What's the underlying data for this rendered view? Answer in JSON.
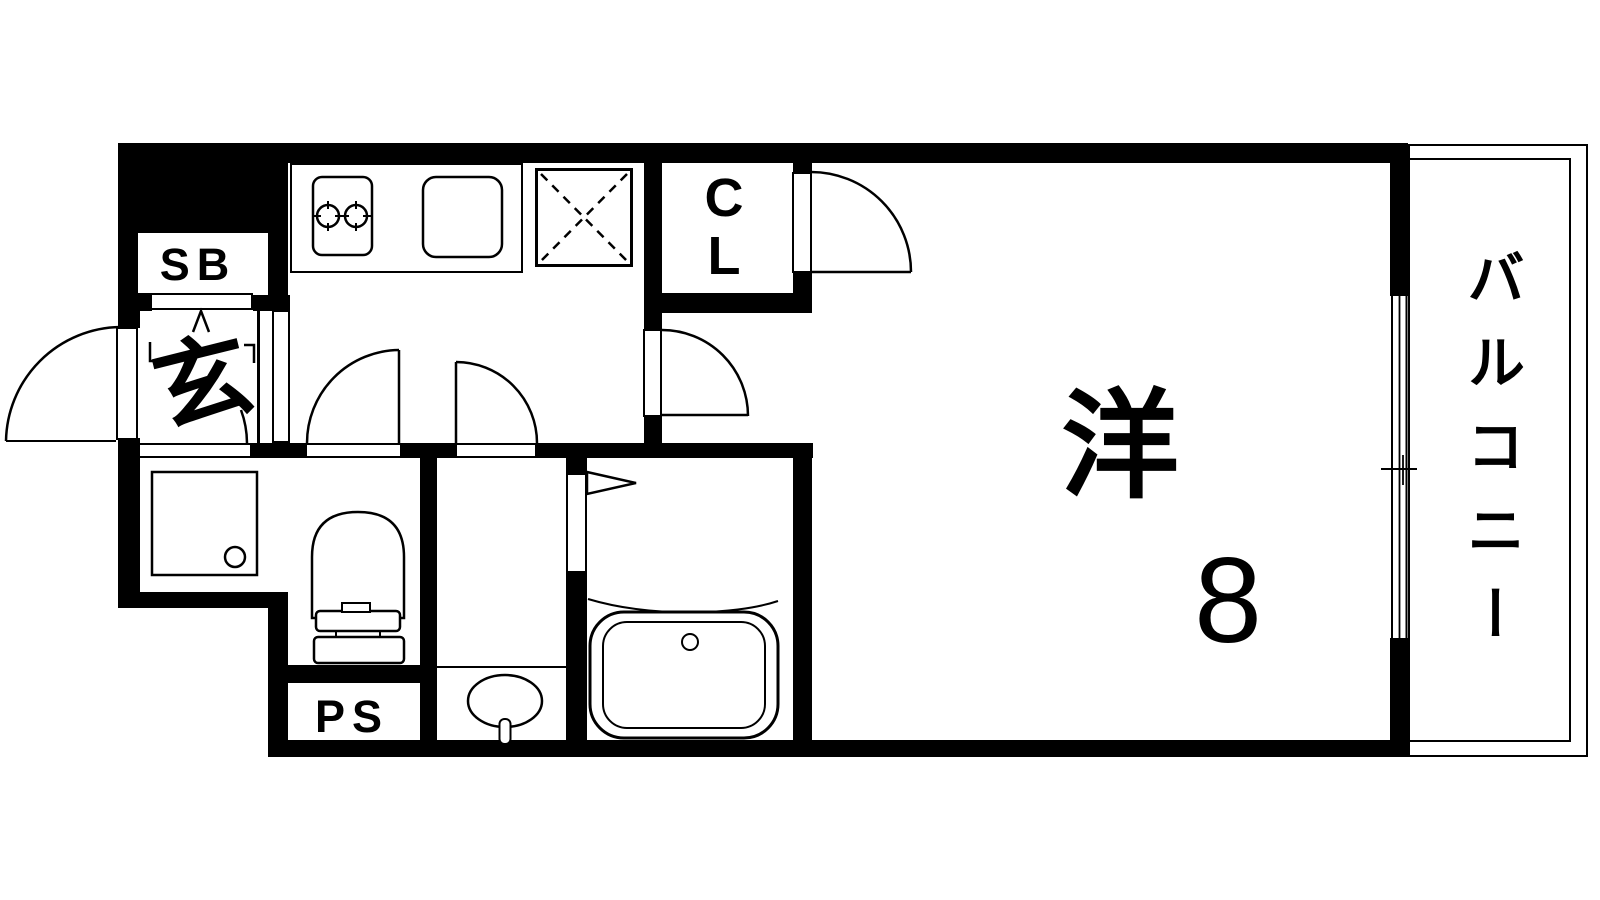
{
  "plan": {
    "type": "floor-plan",
    "colors": {
      "line": "#000000",
      "background": "#ffffff"
    },
    "labels": {
      "shoe_box": "SB",
      "entrance": "玄",
      "closet_line1": "C",
      "closet_line2": "L",
      "pipe_space": "PS",
      "main_room": "洋",
      "main_room_size": "8",
      "balcony": "バルコニー"
    },
    "fixtures": [
      "stove",
      "kitchen-sink",
      "refrigerator-space",
      "washing-machine-pan",
      "toilet",
      "washbasin",
      "bathtub",
      "sliding-window",
      "hinged-door"
    ]
  }
}
